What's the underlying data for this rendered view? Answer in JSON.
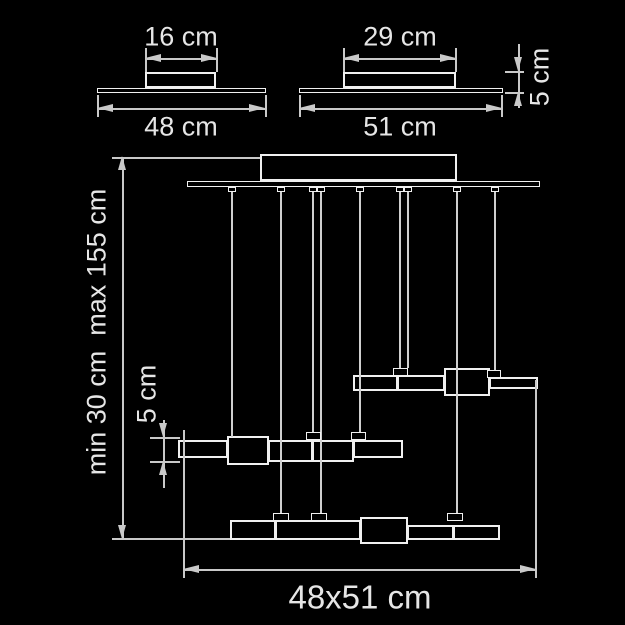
{
  "colors": {
    "background": "#000000",
    "object_line": "#f0f0f0",
    "dimension_line": "#c9c9c9",
    "label_text": "#e6e6e6"
  },
  "labels": {
    "small_unit": {
      "top_width": "16 cm",
      "base_width": "48 cm"
    },
    "large_unit": {
      "top_width": "29 cm",
      "base_width": "51 cm",
      "height": "5 cm"
    },
    "assembly": {
      "suspension_range": "min 30 cm  max 155 cm",
      "element_height": "5 cm",
      "footprint": "48x51 cm"
    }
  }
}
